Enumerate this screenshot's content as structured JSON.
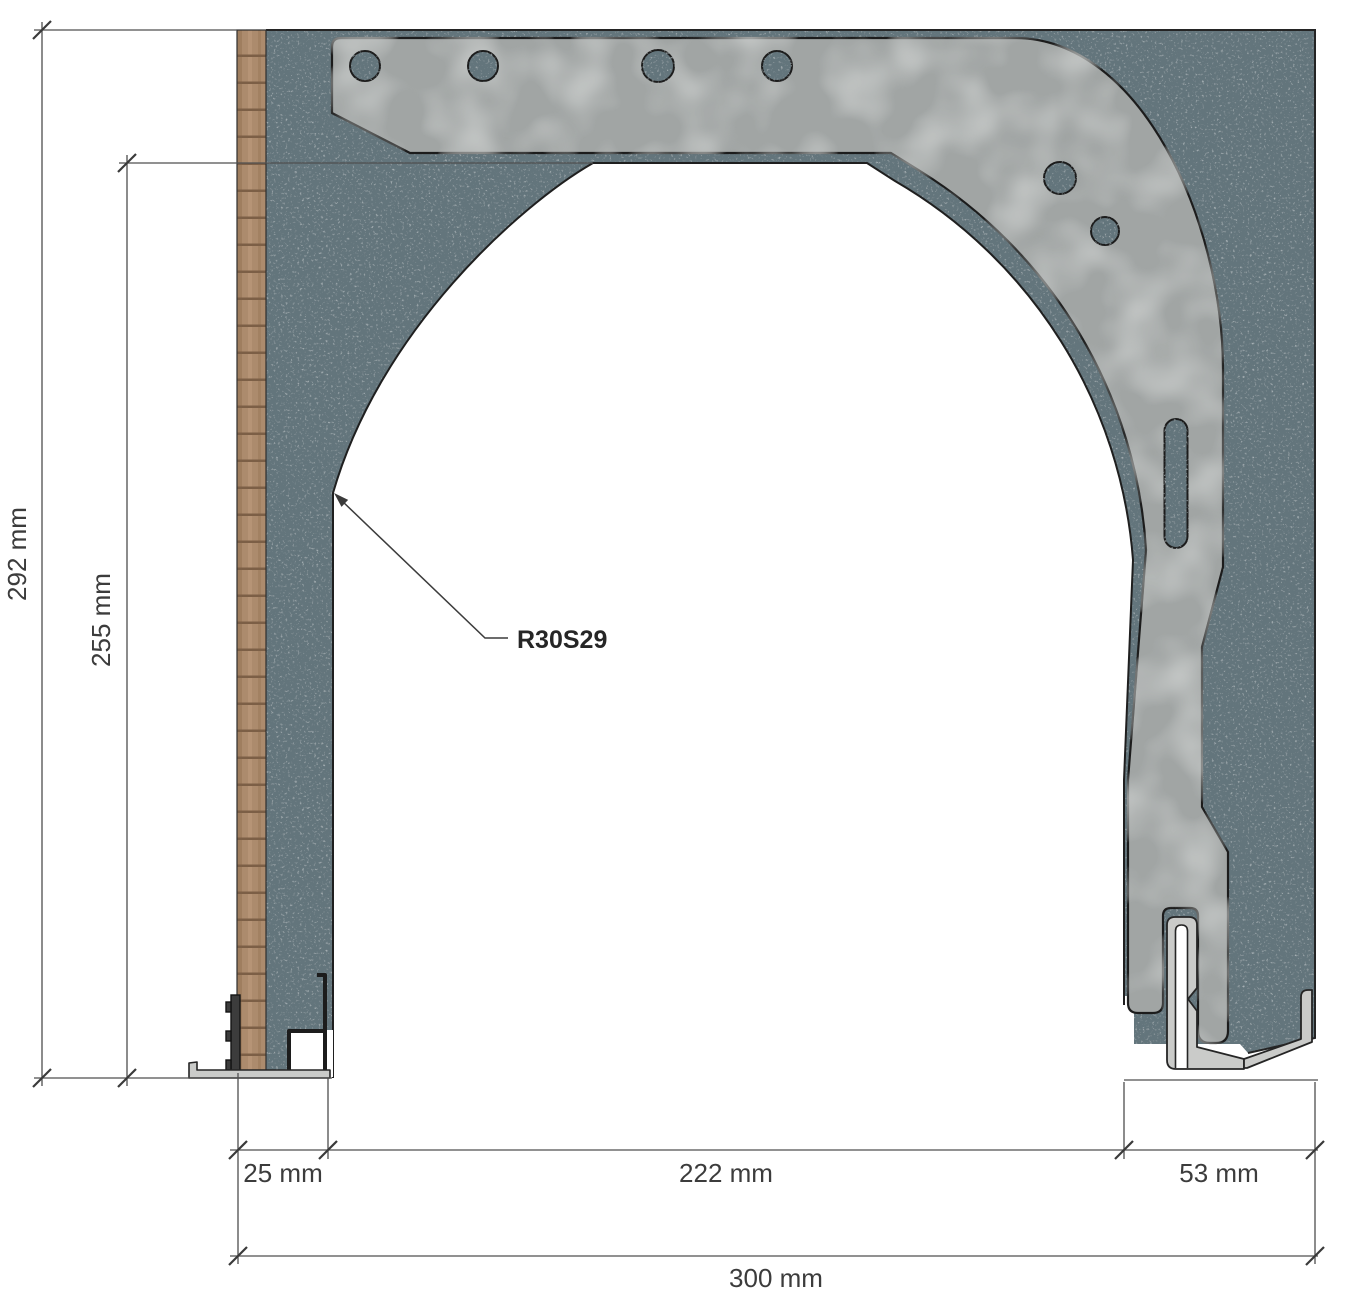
{
  "drawing": {
    "type_label": "R30S29",
    "dims": {
      "total_height": "292 mm",
      "opening_height": "255 mm",
      "lining_thickness": "25 mm",
      "opening_width": "222 mm",
      "box_side": "53 mm",
      "total_width": "300 mm"
    },
    "colors": {
      "masonry": "#64747b",
      "wood": "#ac8b6d",
      "metal": "#a1a5a4",
      "aluminium": "#cacbc9",
      "outline": "#1f1f1f",
      "dimension_line": "#4f4f4f",
      "text": "#3c3c3c",
      "callout_text": "#262626",
      "dark_profile": "#3c3c3c",
      "opening": "#ffffff"
    }
  }
}
